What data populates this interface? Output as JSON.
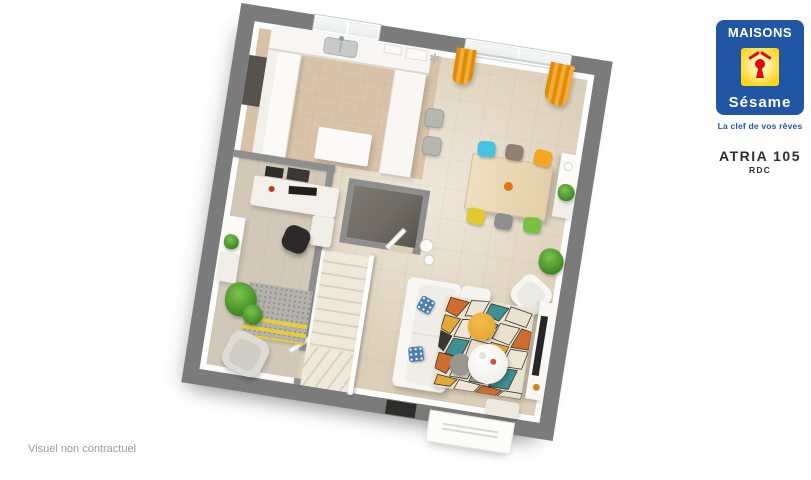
{
  "brand": {
    "name_top": "MAISONS",
    "name_bottom": "Sésame",
    "tagline": "La clef de vos rêves",
    "logo_icon": "keyhole-house-icon"
  },
  "plan": {
    "model_name": "ATRIA 105",
    "floor_label": "RDC",
    "disclaimer": "Visuel non contractuel",
    "view": "3d-floor-plan, rotated ~9deg clockwise"
  },
  "floorplan_contents": {
    "kitchen": [
      "counter along top wall with sink under window",
      "tall cabinets",
      "bar peninsula",
      "2 bar stools",
      "white island table",
      "wall shelves",
      "dark recess to storage"
    ],
    "dining_area": [
      "large window with two orange curtains",
      "light-wood 6-seat table with orange bowl",
      "chairs: cyan, taupe, orange, yellow, gray, green",
      "white sideboard with plant and vase"
    ],
    "living_area": [
      "L-shaped white sofa with blue patterned pillows",
      "geometric multicolor rug",
      "round white coffee table",
      "mustard pouf",
      "gray side disc",
      "white armchair",
      "TV unit with black TV",
      "green plants",
      "bench"
    ],
    "office": [
      "corner desk with black monitor and red mug",
      "black desk chair",
      "black wall shelves",
      "white cabinet with plant",
      "gray rug with yellow stripes",
      "light-gray armchair",
      "two green plants"
    ],
    "core": [
      "L staircase with white railing and winder steps",
      "dark WC/storage room with open white door",
      "two white fixtures",
      "black front door in wall",
      "white porch mat outside"
    ]
  },
  "theme": {
    "brand_blue": "#2156a5",
    "brand_yellow": "#ffd51c",
    "brand_red": "#e30613",
    "text_dark": "#2f2f2f",
    "watermark_gray": "#9b9b9b",
    "wall_gray": "#7b7b7b",
    "partition_gray": "#8e8e8e",
    "floor_beige": "#dccfb8",
    "floor_kitchen": "#d8c3a9",
    "floor_office": "#d2c8b8",
    "curtain_orange": "#ef9b16",
    "chair_cyan": "#45c3e0",
    "chair_taupe": "#8f8071",
    "chair_orange": "#f5a623",
    "chair_yellow": "#e3c832",
    "chair_gray": "#8f8f8f",
    "chair_green": "#7ac143",
    "rug_teal": "#3f8f96",
    "rug_orange": "#cf6d2f",
    "rug_mustard": "#e2a93a",
    "rug_black": "#3b352c",
    "rug_yellow": "#e6cf35",
    "plant_green": "#3f8724",
    "pouf_mustard": "#e9a930",
    "stair_cream": "#efe9dc",
    "wc_dark": "#6f6b62",
    "tv_black": "#262626"
  }
}
